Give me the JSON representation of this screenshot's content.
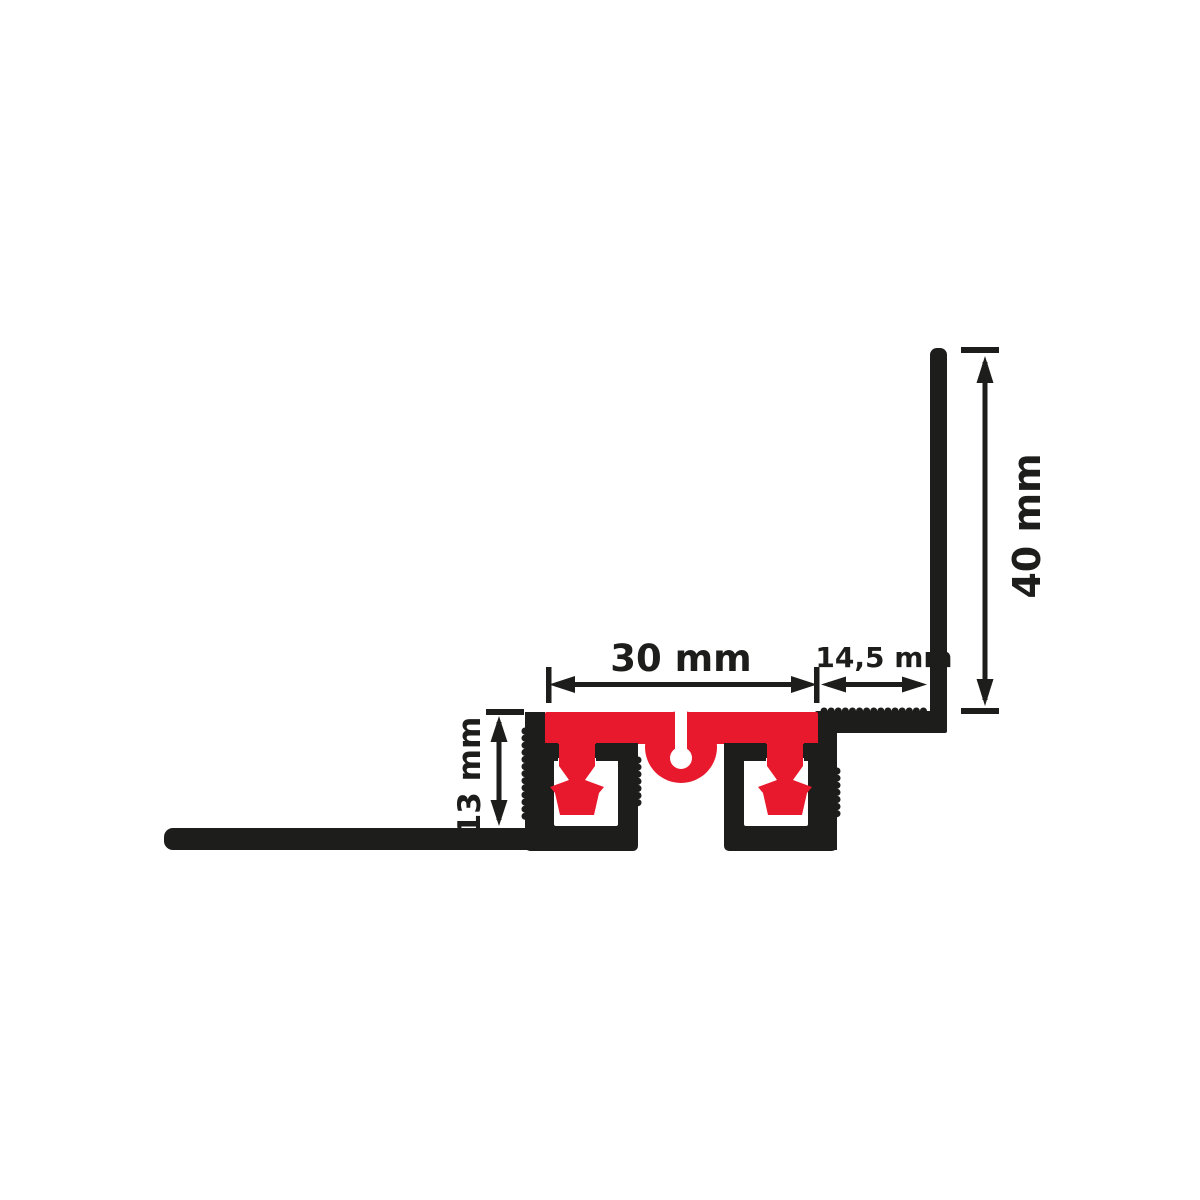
{
  "drawing": {
    "dimensions": {
      "joint_width": "30 mm",
      "side_flange_width": "14,5 mm",
      "upstand_height": "40 mm",
      "profile_depth": "13 mm"
    },
    "colors": {
      "black": "#1d1d1b",
      "red": "#e8192c",
      "background": "#ffffff"
    }
  }
}
